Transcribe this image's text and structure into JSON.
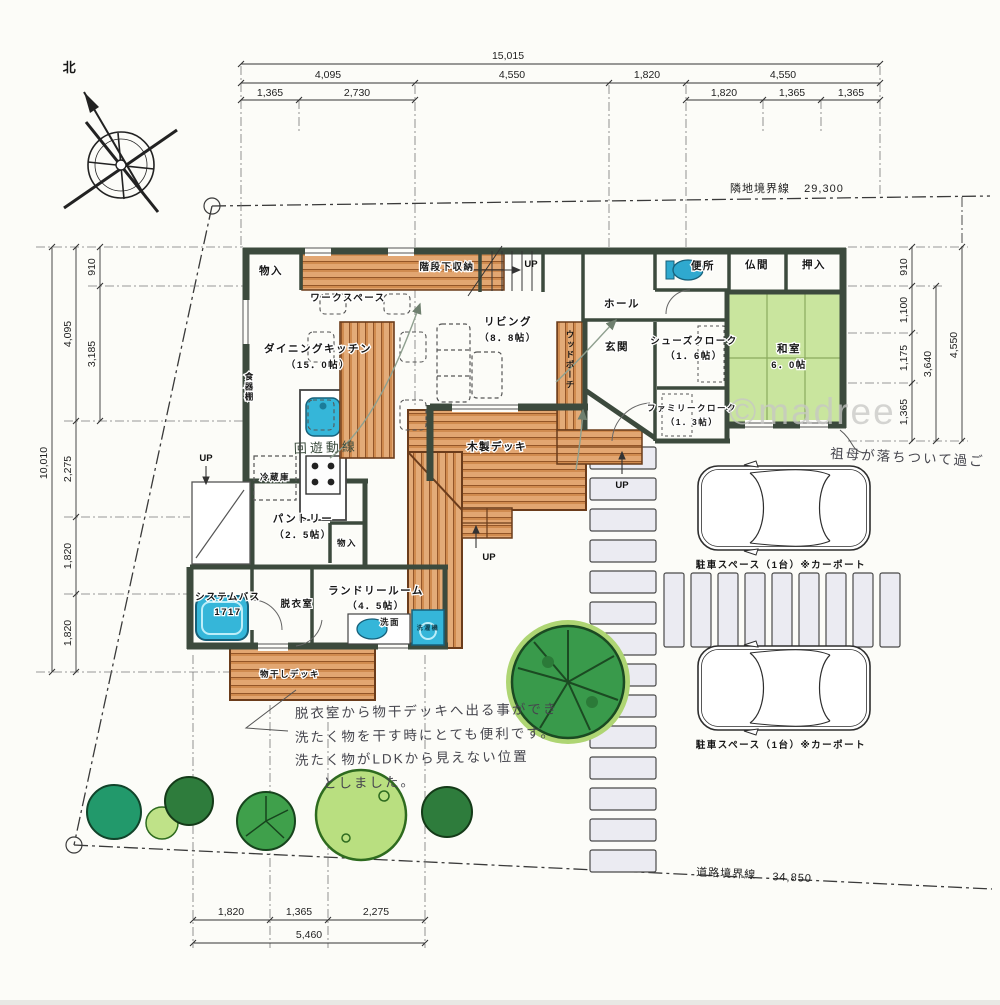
{
  "compass": {
    "north": "北"
  },
  "boundaries": {
    "adjacent_label": "隣地境界線",
    "adjacent_value": "29,300",
    "road_label": "道路境界線",
    "road_value": "34,850"
  },
  "dims": {
    "top_total": "15,015",
    "top_row2": [
      "4,095",
      "4,550",
      "1,820",
      "4,550"
    ],
    "top_row3_left": [
      "1,365",
      "2,730"
    ],
    "top_row3_right": [
      "1,820",
      "1,365",
      "1,365"
    ],
    "left_total": "10,010",
    "left_mid": [
      "4,095",
      "2,275",
      "1,820",
      "1,820"
    ],
    "left_inner": [
      "910",
      "3,185"
    ],
    "right_total": "4,550",
    "right_mid": "3,640",
    "right_inner": [
      "910",
      "1,100",
      "1,175",
      "1,365"
    ],
    "bottom_row": [
      "1,820",
      "1,365",
      "2,275"
    ],
    "bottom_total": "5,460"
  },
  "rooms": {
    "storage1": "物入",
    "workspace": "ワークスペース",
    "stair_storage": "階段下収納",
    "up": "UP",
    "hall": "ホール",
    "toilet": "便所",
    "butsuma": "仏間",
    "oshiire": "押入",
    "living": "リビング",
    "living_size": "（8．8帖）",
    "dining_kitchen": "ダイニングキッチン",
    "dining_kitchen_size": "（15．0帖）",
    "genkan": "玄関",
    "shoes_cloak": "シューズクローク",
    "shoes_cloak_size": "（1．6帖）",
    "washitsu": "和室",
    "washitsu_size": "6．0帖",
    "family_cloak": "ファミリークローク",
    "family_cloak_size": "（1．3帖）",
    "cupboard": "食器棚",
    "refrigerator": "冷蔵庫",
    "pantry": "パントリー",
    "pantry_size": "（2．5帖）",
    "storage2": "物入",
    "system_bath": "システムバス",
    "system_bath_size": "1717",
    "dressing_room": "脱衣室",
    "laundry_room": "ランドリールーム",
    "laundry_room_size": "（4．5帖）",
    "washstand": "洗面",
    "washing_machine": "洗濯機",
    "wood_deck": "木製デッキ",
    "drying_deck": "物干しデッキ",
    "wood_porch": "ウッドポーチ"
  },
  "exterior": {
    "parking1": "駐車スペース（1台）※カーポート",
    "parking2": "駐車スペース（1台）※カーポート"
  },
  "annotations": {
    "circulation": "回遊動線",
    "note_laundry": [
      "脱衣室から物干デッキへ出る事ができ",
      "洗たく物を干す時にとても便利です。",
      "洗たく物がLDKから見えない位置",
      "としました。"
    ],
    "note_washitsu": "祖母が落ちついて過ご"
  },
  "watermark": "©madree"
}
